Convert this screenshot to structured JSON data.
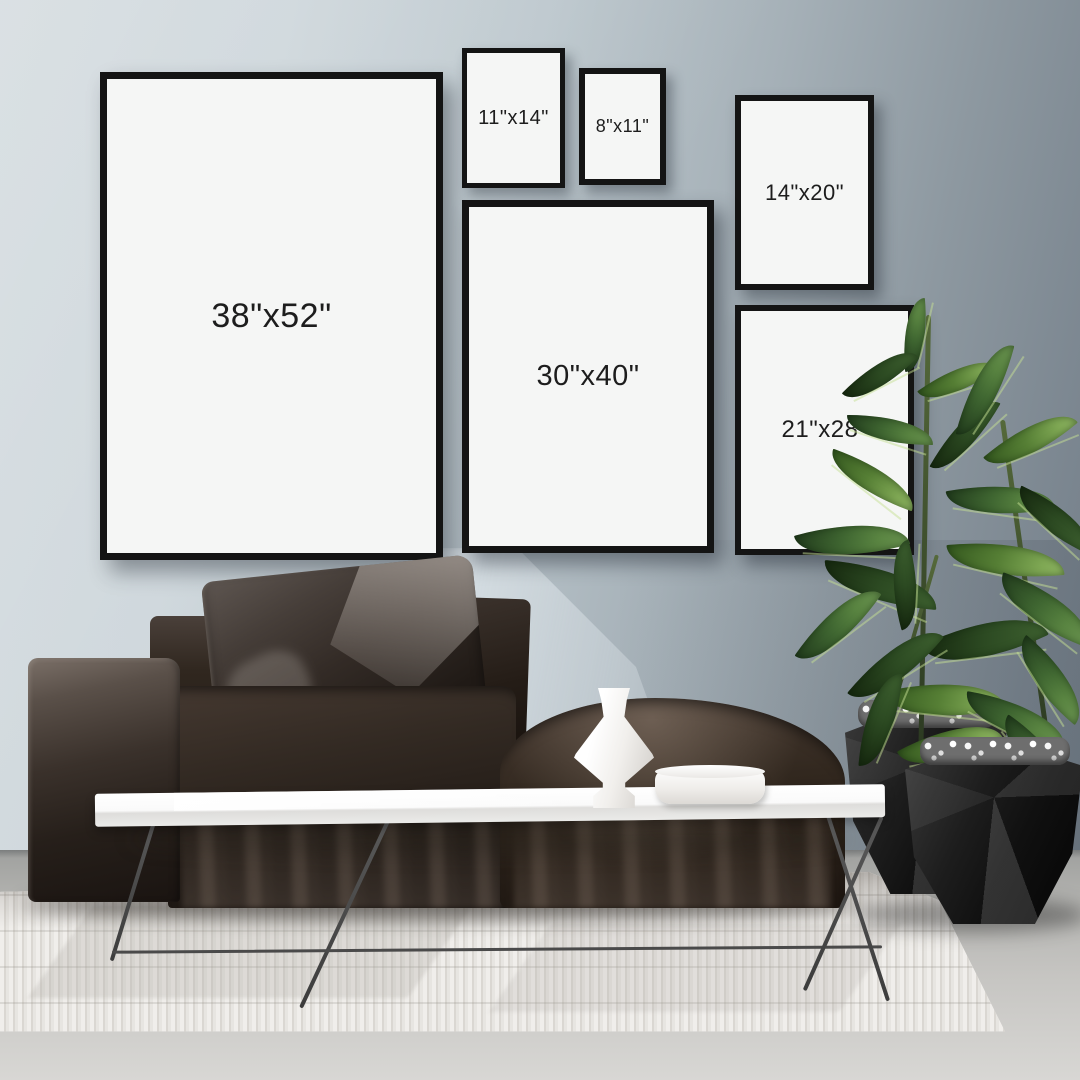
{
  "scene": {
    "description": "Living room gallery wall poster size mockup with six black frames, dark modular sofa, white coffee table, rubber plant in black geometric planters and a white textured rug",
    "frames": [
      {
        "id": "frame-38x52",
        "label": "38\"x52\""
      },
      {
        "id": "frame-11x14",
        "label": "11\"x14\""
      },
      {
        "id": "frame-8x11",
        "label": "8\"x11\""
      },
      {
        "id": "frame-14x20",
        "label": "14\"x20\""
      },
      {
        "id": "frame-30x40",
        "label": "30\"x40\""
      },
      {
        "id": "frame-21x28",
        "label": "21\"x28\""
      }
    ]
  },
  "colors": {
    "wall_light": "#ccd5da",
    "wall_dark": "#6f7a84",
    "frame_border": "#141414",
    "poster_white": "#f5f6f5",
    "label_color": "#1d1d1d",
    "sofa_dark": "#241c17",
    "table_white": "#fafafa",
    "rug_white": "#e9e7e3",
    "floor_gray": "#c6c5c2",
    "plant_green": "#4c7a3a",
    "planter_black": "#101010"
  }
}
